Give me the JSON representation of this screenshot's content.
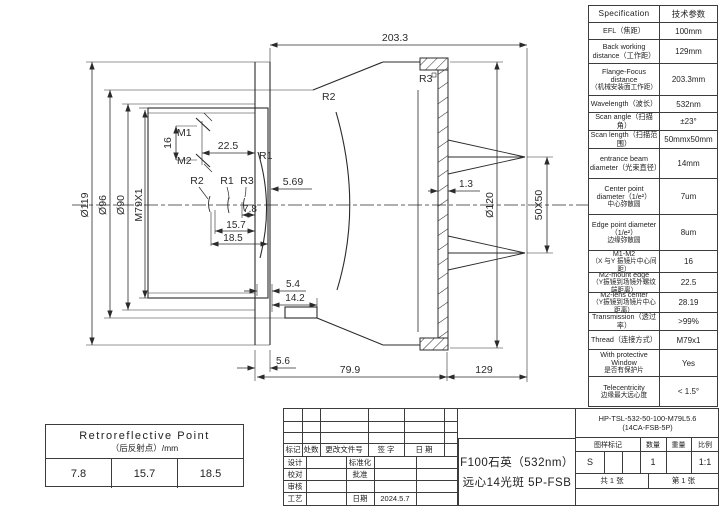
{
  "drawing": {
    "labels": {
      "len_total": "203.3",
      "dia119": "Ø119",
      "dia96": "Ø96",
      "dia90": "Ø90",
      "thread": "M79X1",
      "gap16": "16",
      "d225": "22.5",
      "m1": "M1",
      "m2": "M2",
      "r1_front": "R1",
      "r2_group": "R2",
      "r1_group": "R1",
      "r3_group": "R3",
      "d569": "5.69",
      "d78": "7.8",
      "d157": "15.7",
      "d185": "18.5",
      "r2_main": "R2",
      "r3_window": "R3",
      "d13": "1.3",
      "dia120": "Ø120",
      "scan_field": "50X50",
      "d54": "5.4",
      "d142": "14.2",
      "d56": "5.6",
      "d799": "79.9",
      "d129": "129"
    }
  },
  "spec": {
    "rows": [
      {
        "en": "Specification",
        "zh": "",
        "value": "技术参数",
        "h": 17
      },
      {
        "en": "EFL（焦距）",
        "zh": "",
        "value": "100mm",
        "h": 17
      },
      {
        "en": "Back working distance（工作距）",
        "zh": "",
        "value": "129mm",
        "h": 24
      },
      {
        "en": "Flange-Focus distance",
        "zh": "（机械安装面工作距）",
        "value": "203.3mm",
        "h": 32
      },
      {
        "en": "Wavelength（波长）",
        "zh": "",
        "value": "532nm",
        "h": 17
      },
      {
        "en": "Scan angle（扫描角）",
        "zh": "",
        "value": "±23°",
        "h": 18
      },
      {
        "en": "Scan length（扫描范围）",
        "zh": "",
        "value": "50mmx50mm",
        "h": 18
      },
      {
        "en": "entrance beam diameter（光束直径）",
        "zh": "",
        "value": "14mm",
        "h": 30
      },
      {
        "en": "Center point diameter（1/e²）",
        "zh": "中心弥散圆",
        "value": "7um",
        "h": 36
      },
      {
        "en": "Edge point diameter（1/e²）",
        "zh": "边缘弥散圆",
        "value": "8um",
        "h": 36
      },
      {
        "en": "M1-M2",
        "zh": "（X 与Y 振镜片中心间距）",
        "value": "16",
        "h": 22
      },
      {
        "en": "M2-mount edge",
        "zh": "（Y振镜到场镜外螺纹端距离）",
        "value": "22.5",
        "h": 20
      },
      {
        "en": "M2-lens center",
        "zh": "（Y振镜到场镜片中心距离）",
        "value": "28.19",
        "h": 20
      },
      {
        "en": "Transmission（透过率）",
        "zh": "",
        "value": ">99%",
        "h": 18
      },
      {
        "en": "Thread（连接方式）",
        "zh": "",
        "value": "M79x1",
        "h": 19
      },
      {
        "en": "With protective Window",
        "zh": "是否有保护片",
        "value": "Yes",
        "h": 27
      },
      {
        "en": "Telecentricity",
        "zh": "边缘最大远心度",
        "value": "< 1.5°",
        "h": 29
      }
    ]
  },
  "retro": {
    "title_en": "Retroreflective Point",
    "title_zh": "（后反射点）/mm",
    "values": [
      "7.8",
      "15.7",
      "18.5"
    ]
  },
  "titleblock": {
    "part_no_line1": "HP-TSL-532-50-100-M79L5.6",
    "part_no_line2": "(14CA-FSB-5P)",
    "title_line1": "F100石英（532nm）",
    "title_line2": "远心14光斑 5P-FSB",
    "rev_headers": [
      "标记",
      "处数",
      "更改文件号",
      "签 字",
      "日 期"
    ],
    "role_design": "设计",
    "role_check": "校对",
    "role_review": "审核",
    "role_process": "工艺",
    "role_std": "标准化",
    "role_approve": "批准",
    "role_date": "日期",
    "date_value": "2024.5.7",
    "stamp_headers": [
      "图样标记",
      "数量",
      "重量",
      "比例"
    ],
    "stamp_mark": "S",
    "stamp_qty": "1",
    "stamp_weight": "",
    "stamp_scale": "1:1",
    "sheets_total": "共 1 张",
    "sheet_no": "第 1 张"
  }
}
